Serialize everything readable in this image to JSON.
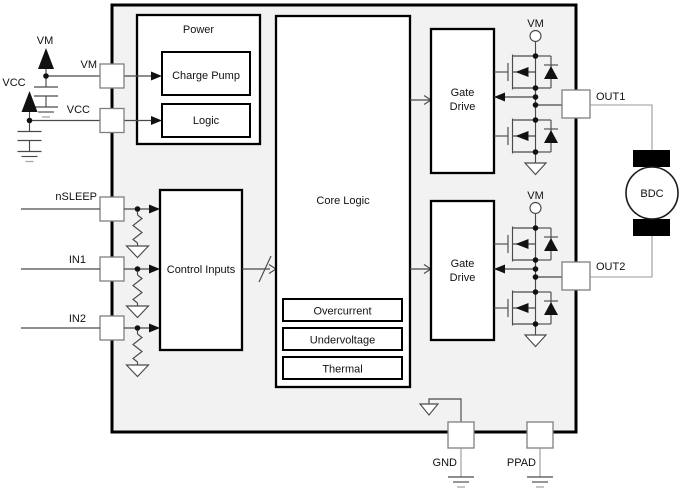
{
  "labels": {
    "power": "Power",
    "charge_pump": "Charge Pump",
    "logic": "Logic",
    "core_logic": "Core Logic",
    "control_inputs": "Control Inputs",
    "gate_drive_line1": "Gate",
    "gate_drive_line2": "Drive",
    "overcurrent": "Overcurrent",
    "undervoltage": "Undervoltage",
    "thermal": "Thermal",
    "motor": "BDC"
  },
  "pins": {
    "vm": "VM",
    "vcc": "VCC",
    "nsleep": "nSLEEP",
    "in1": "IN1",
    "in2": "IN2",
    "out1": "OUT1",
    "out2": "OUT2",
    "gnd": "GND",
    "ppad": "PPAD"
  },
  "supplies": {
    "vm_label": "VM",
    "vcc_label": "VCC",
    "bridge_vm_label": "VM"
  },
  "colors": {
    "chip_fill": "#f2f2f2",
    "block_fill": "#ffffff",
    "outline": "#000000",
    "wire": "#4a4a4a",
    "pin_border": "#7f7f7f",
    "external_wire": "#999999"
  }
}
